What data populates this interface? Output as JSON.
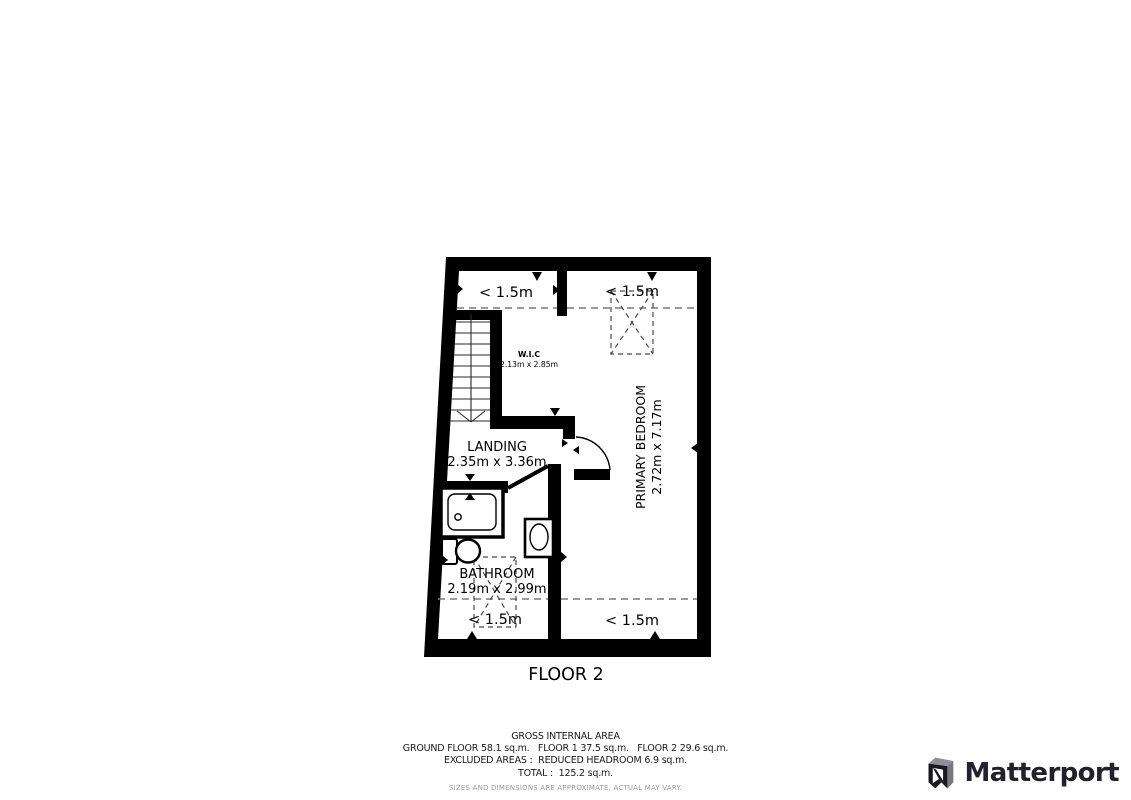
{
  "plan": {
    "floor_label": "FLOOR 2",
    "rooms": [
      {
        "name": "W.I.C",
        "dims": "2.13m x 2.85m"
      },
      {
        "name": "LANDING",
        "dims": "2.35m x 3.36m"
      },
      {
        "name": "PRIMARY BEDROOM",
        "dims": "2.72m x 7.17m"
      },
      {
        "name": "BATHROOM",
        "dims": "2.19m x 2.99m"
      }
    ],
    "headroom_labels": [
      "< 1.5m",
      "< 1.5m",
      "< 1.5m",
      "< 1.5m"
    ]
  },
  "footer": {
    "title": "GROSS INTERNAL AREA",
    "areas_line": "GROUND FLOOR 58.1 sq.m.   FLOOR 1 37.5 sq.m.   FLOOR 2 29.6 sq.m.",
    "excluded_line": "EXCLUDED AREAS :  REDUCED HEADROOM 6.9 sq.m.",
    "total_line": "TOTAL :  125.2 sq.m.",
    "disclaimer": "SIZES AND DIMENSIONS ARE APPROXIMATE, ACTUAL MAY VARY."
  },
  "brand": {
    "wordmark": "Matterport",
    "icon": "matterport-m-icon",
    "color": "#232129"
  },
  "colors": {
    "walls": "#000000",
    "dashed_lines": "#7a7a7a",
    "headroom_box": "#4a4a4a",
    "disclaimer": "#9b9b9b"
  }
}
